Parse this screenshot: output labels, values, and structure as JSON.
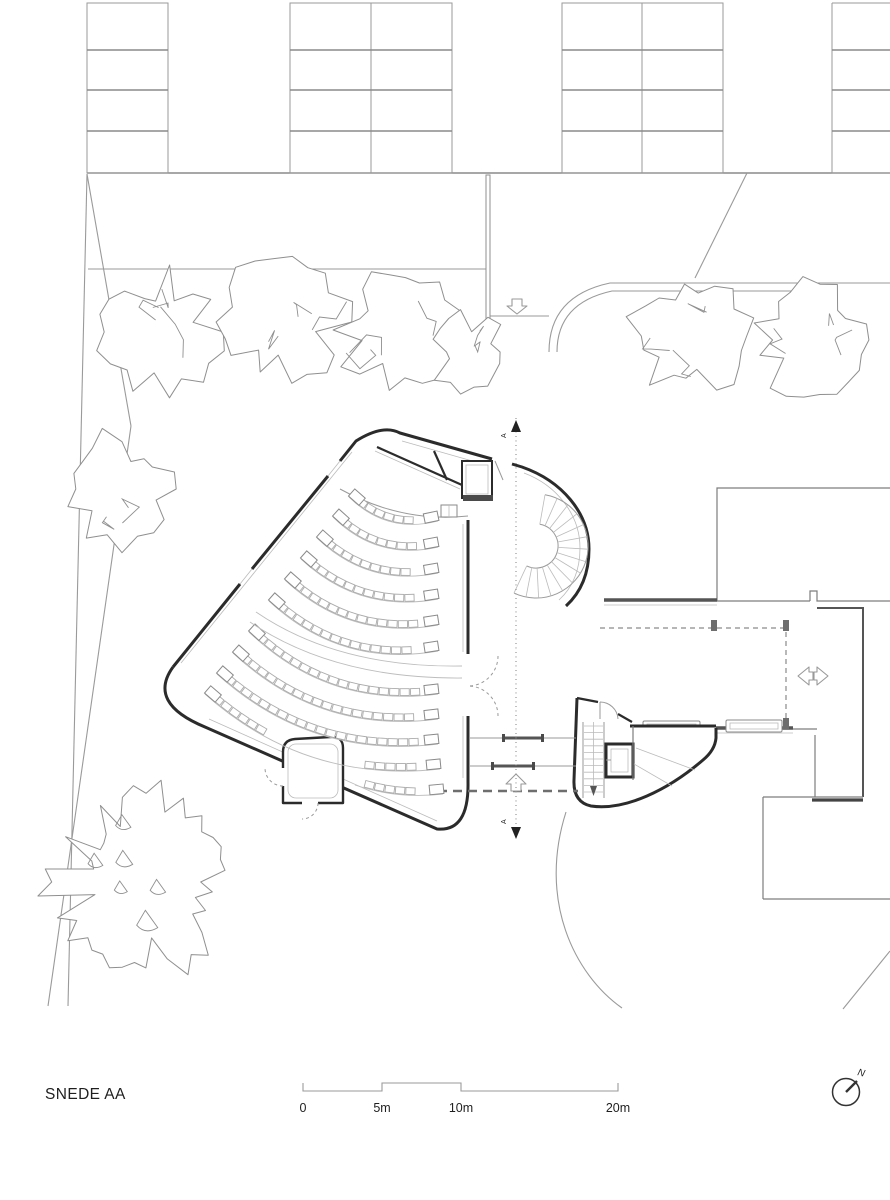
{
  "drawing": {
    "title": "SNEDE AA",
    "section_marker": "A",
    "north_label": "N",
    "scale_bar": {
      "tick_labels": [
        "0",
        "5m",
        "10m",
        "20m"
      ]
    }
  },
  "colors": {
    "paper": "#ffffff",
    "wall": "#2b2b2b",
    "wall_medium": "#555555",
    "site_line": "#9a9a9a",
    "light_line": "#b5b5b5",
    "seat_line": "#ababab",
    "tree_line": "#8f8f8f",
    "text": "#1f1f1f",
    "column_fill": "#6e6e6e"
  }
}
